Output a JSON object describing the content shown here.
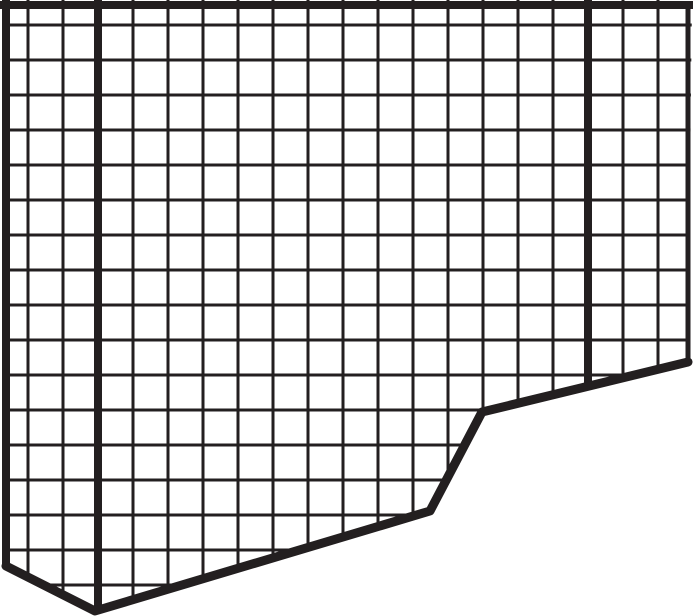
{
  "figure": {
    "title": "torn-graph-paper-grid",
    "canvas": {
      "width": 693,
      "height": 616
    },
    "background_color": "#ffffff",
    "line_color": "#231f20",
    "grid": {
      "spacing": 35,
      "vertical_start_x": 28,
      "vertical_count": 19,
      "horizontal_start_y": 25,
      "horizontal_count": 17,
      "thin_line_width": 3,
      "thick_vertical_x": [
        98,
        588
      ],
      "thick_line_width": 8
    },
    "borders": {
      "top": {
        "y": 5,
        "width": 8,
        "x1": 0,
        "x2": 693
      },
      "left": {
        "x": 6,
        "width": 8,
        "y1": 0,
        "y2": 567
      },
      "right": {
        "x": 688,
        "width": 5,
        "y1": 2,
        "y2": 363
      }
    },
    "outline": {
      "clip_polygon": [
        [
          3,
          0
        ],
        [
          692,
          0
        ],
        [
          688,
          362
        ],
        [
          482,
          412
        ],
        [
          430,
          511
        ],
        [
          95,
          611
        ],
        [
          3,
          566
        ]
      ],
      "torn_edge_points": [
        [
          6,
          566
        ],
        [
          95,
          611
        ],
        [
          430,
          511
        ],
        [
          482,
          412
        ],
        [
          688,
          362
        ]
      ],
      "torn_edge_width": 9
    }
  }
}
